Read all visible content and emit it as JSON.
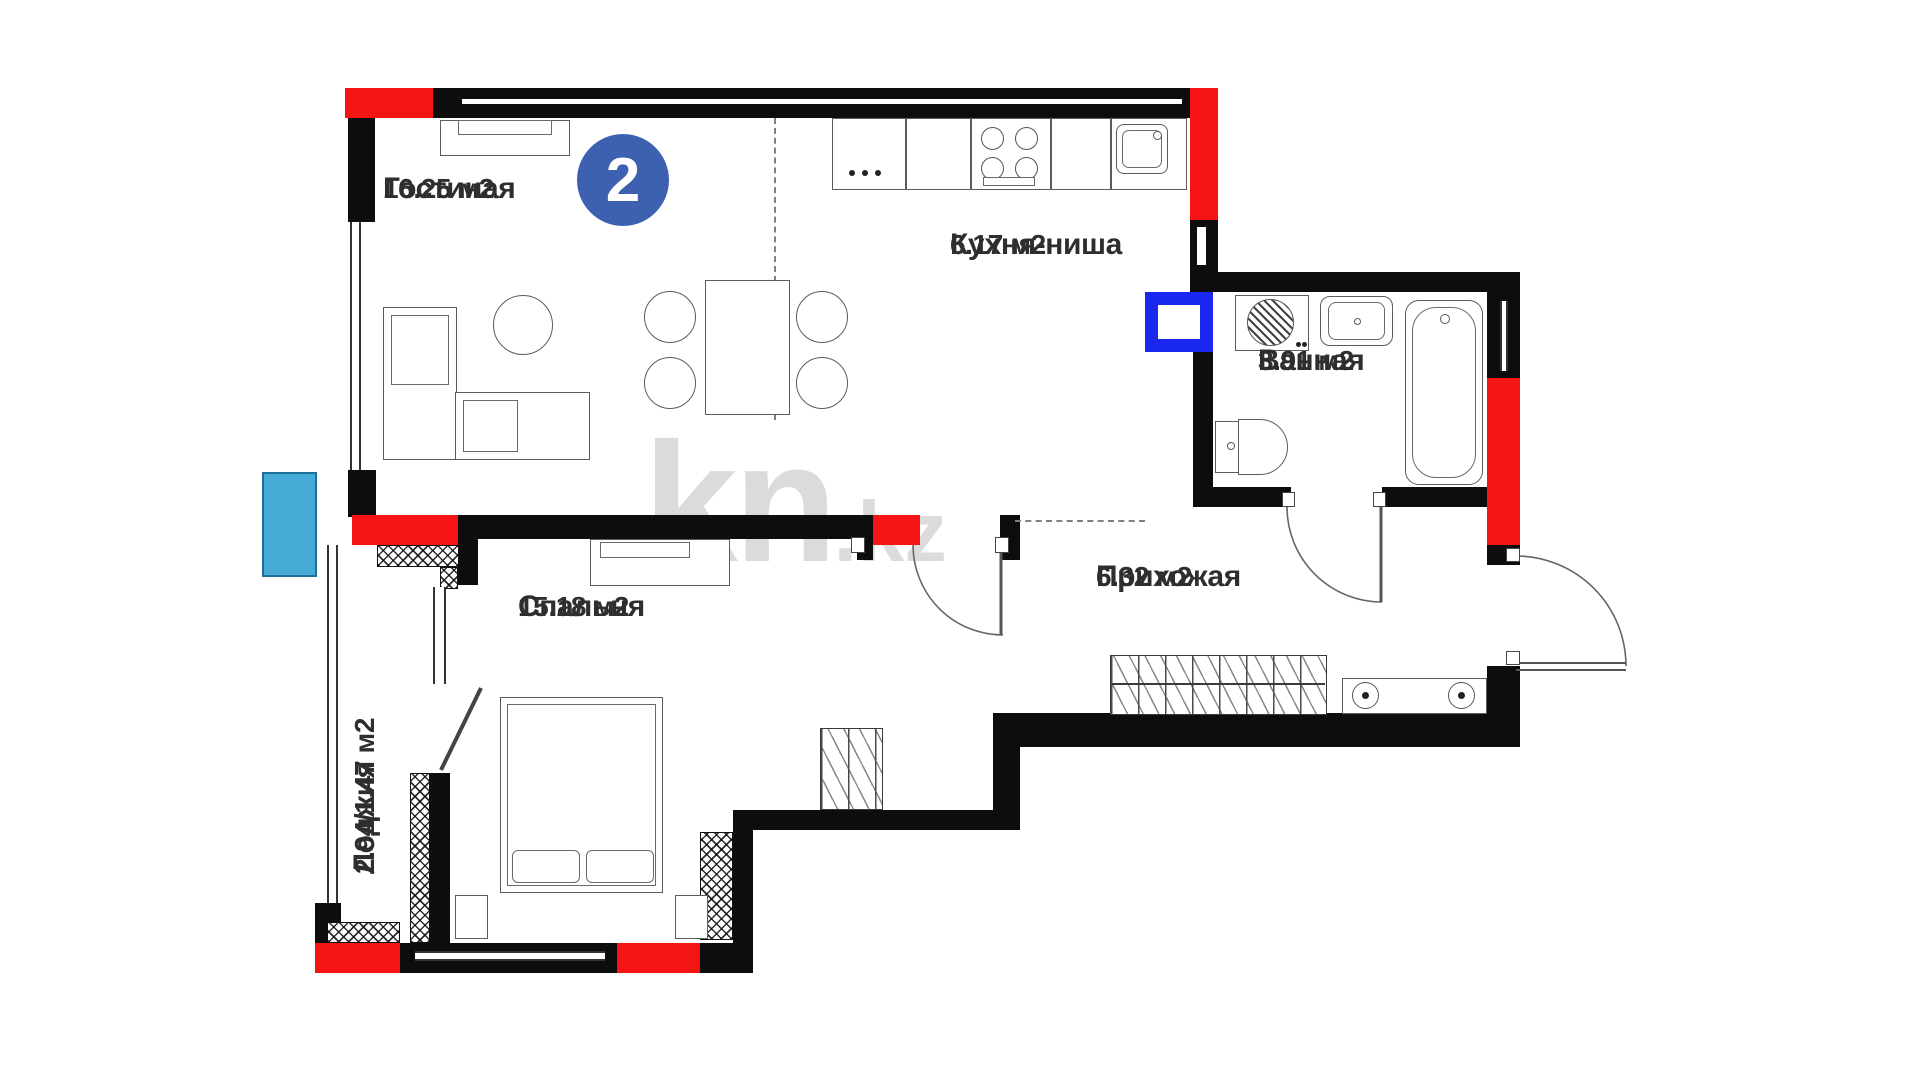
{
  "badge": {
    "number": "2"
  },
  "watermark": {
    "brand": "kn",
    "domain": ".kz"
  },
  "rooms": [
    {
      "name": "Гостиная",
      "area": "16.25 м2"
    },
    {
      "name": "Кухня-ниша",
      "area": "6.17 м2"
    },
    {
      "name": "Ванная",
      "area": "3.91 м2"
    },
    {
      "name": "Прихожая",
      "area": "6.32 м2"
    },
    {
      "name": "Спальня",
      "area": "15.18 м2"
    },
    {
      "name": "Лоджия",
      "area": "2.94/1.47 м2"
    }
  ],
  "colors": {
    "wall_black": "#0d0d0d",
    "highlight_red": "#f51414",
    "badge_blue": "#3d61b0",
    "vent_blue": "#1a27ef",
    "balcony_cyan": "#45aad5",
    "watermark_gray": "#b9b9b9"
  }
}
